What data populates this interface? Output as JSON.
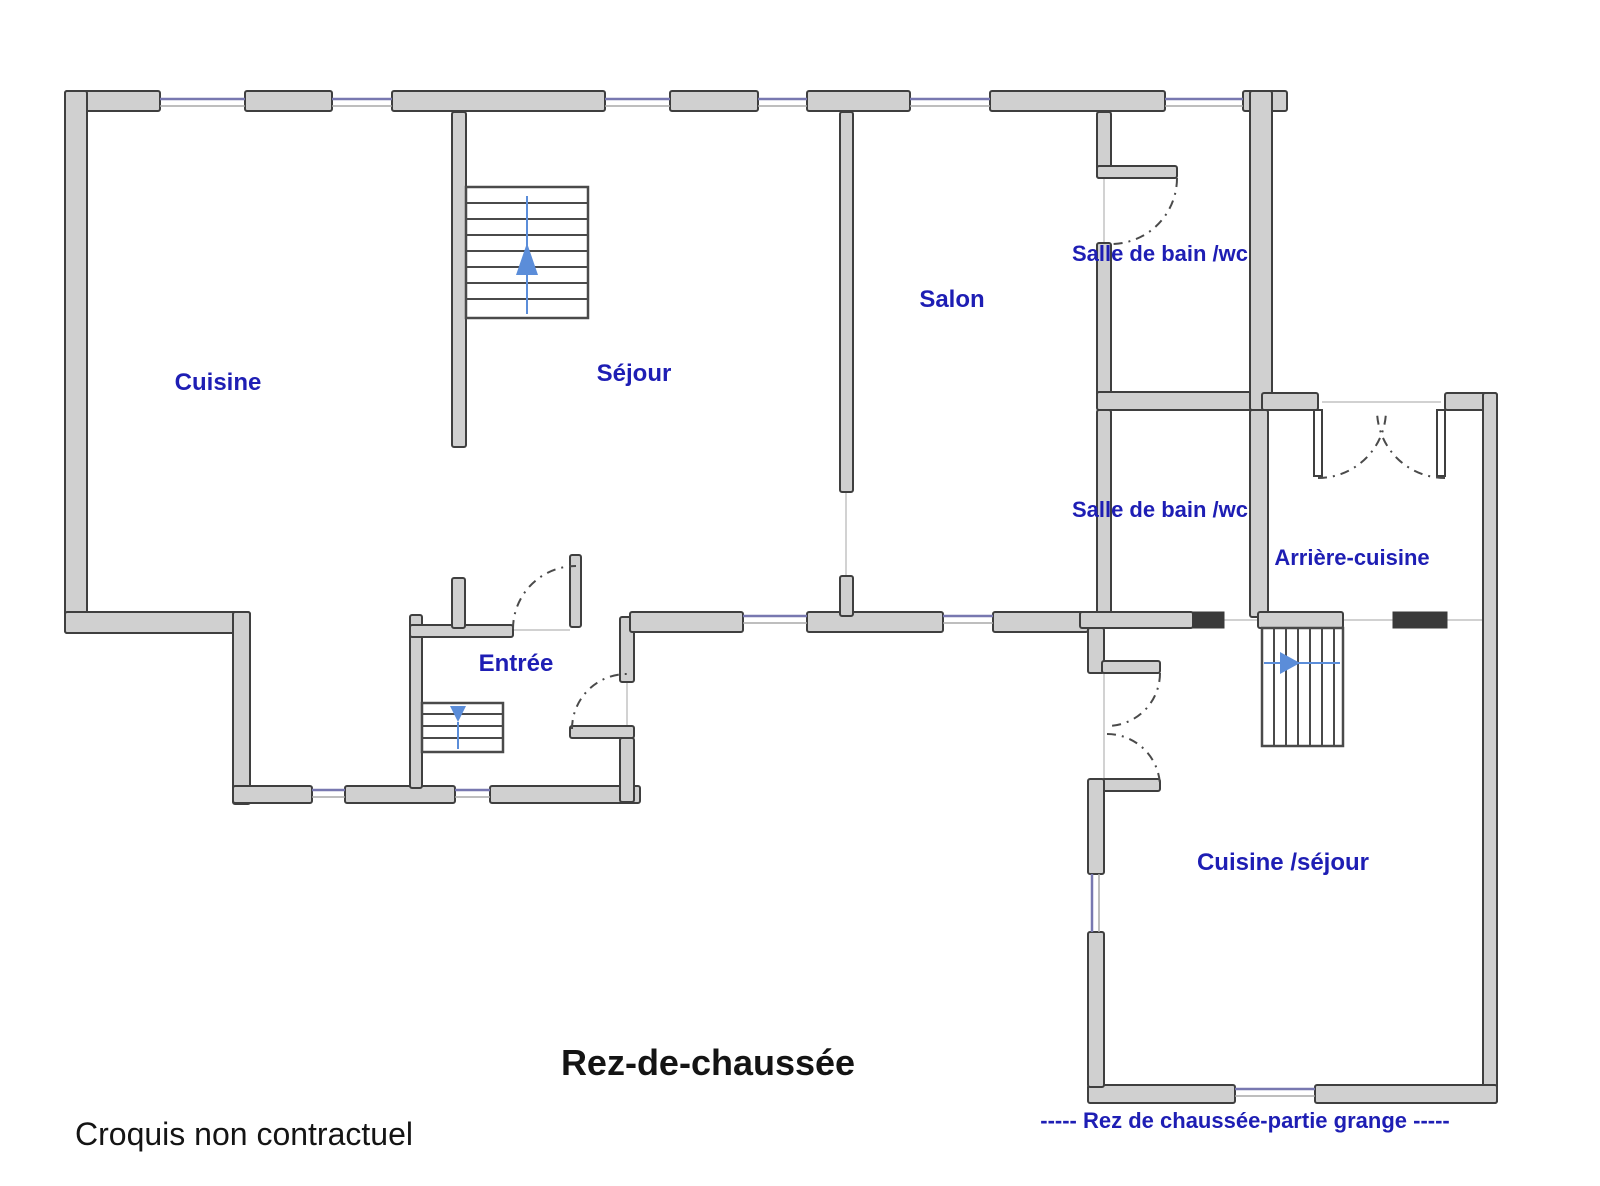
{
  "colors": {
    "background": "#ffffff",
    "wall_fill": "#d0d0d0",
    "wall_outline": "#3f3f3f",
    "wall_dark_segment": "#3a3a3a",
    "window_blue": "#7878b0",
    "room_label_blue": "#1e1eb4",
    "stairs_arrow_blue": "#5b8dd9",
    "text_black": "#141414"
  },
  "rooms": [
    {
      "id": "cuisine",
      "label": "Cuisine"
    },
    {
      "id": "sejour",
      "label": "Séjour"
    },
    {
      "id": "salon",
      "label": "Salon"
    },
    {
      "id": "salle_de_bain_1",
      "label": "Salle de bain /wc"
    },
    {
      "id": "salle_de_bain_2",
      "label": "Salle de bain /wc"
    },
    {
      "id": "arriere_cuisine",
      "label": "Arrière-cuisine"
    },
    {
      "id": "entree",
      "label": "Entrée"
    },
    {
      "id": "cuisine_sejour",
      "label": "Cuisine /séjour"
    }
  ],
  "captions": {
    "floor_title": "Rez-de-chaussée",
    "disclaimer": "Croquis non contractuel",
    "grange_note": "-----   Rez de chaussée-partie grange   -----"
  },
  "icons": {
    "stairs_sejour": "arrow-up",
    "stairs_entree": "arrow-down",
    "stairs_grange": "arrow-right"
  }
}
